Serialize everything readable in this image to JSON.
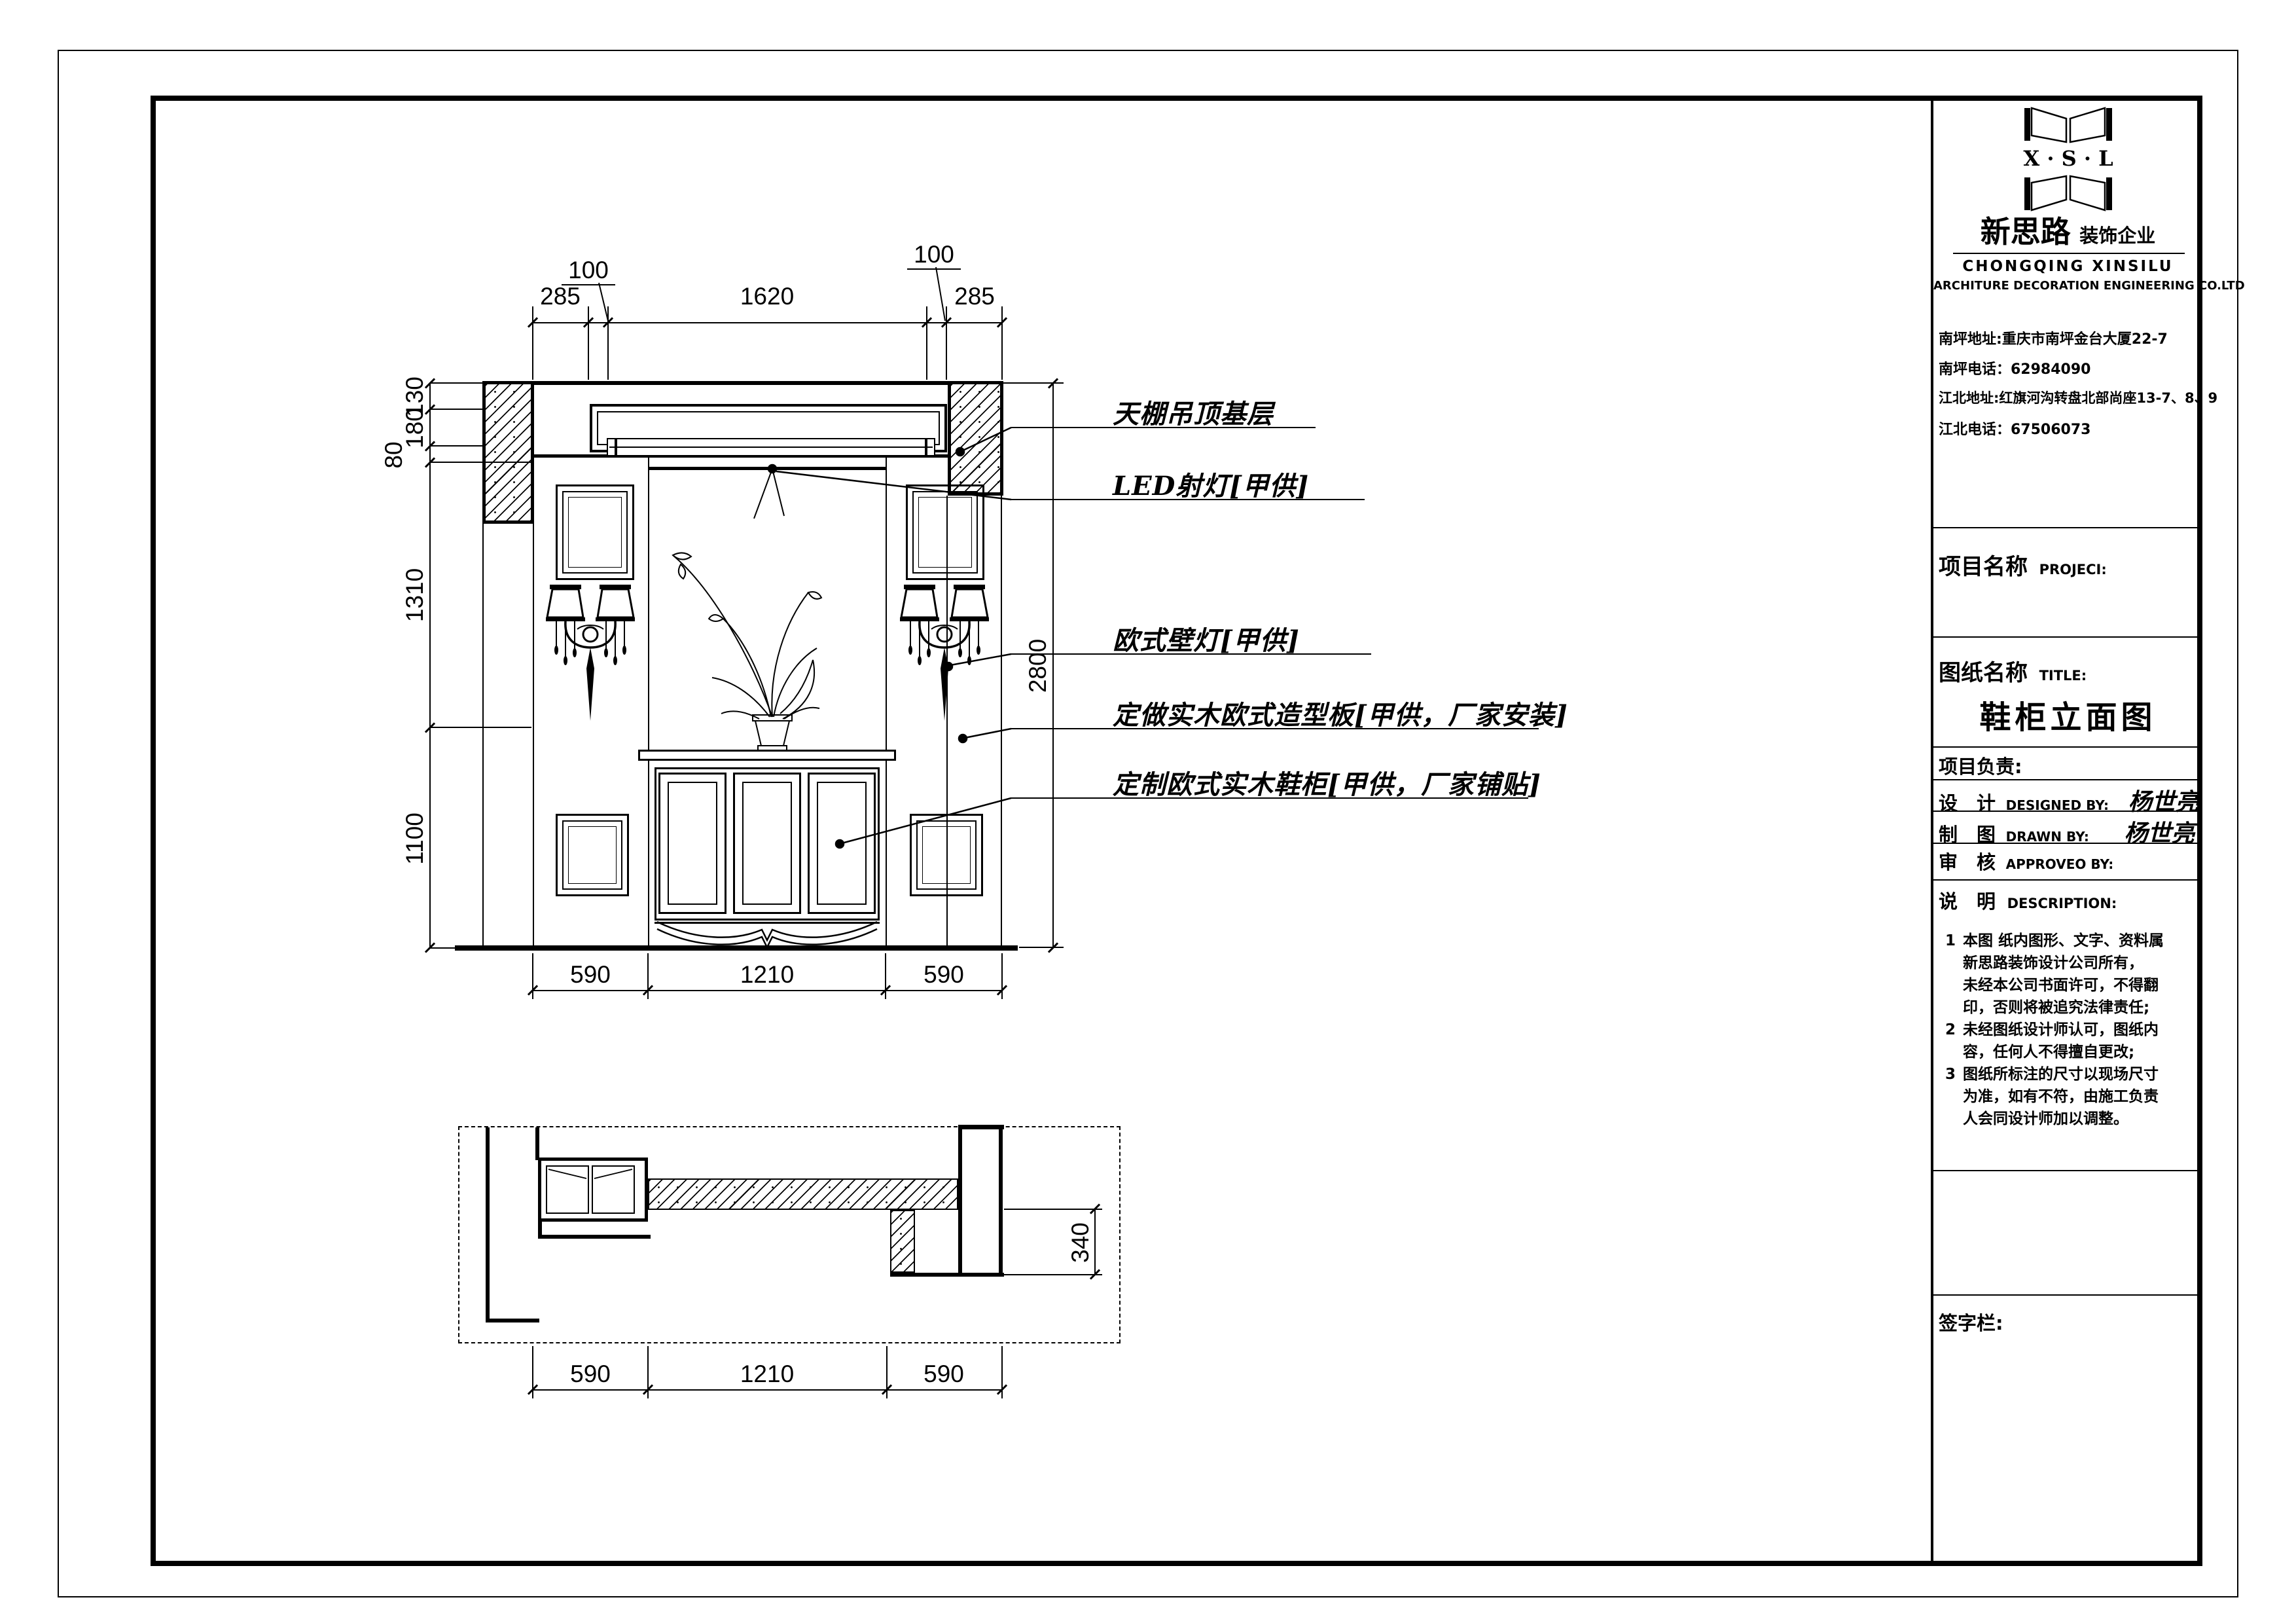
{
  "title_block": {
    "logo": {
      "monogram": "X · S · L",
      "name_cn": "新思路",
      "name_tag": "装饰企业",
      "name_en": "CHONGQING XINSILU",
      "name_en2": "ARCHITURE DECORATION ENGINEERING CO.LTD"
    },
    "contacts": [
      "南坪地址:重庆市南坪金台大厦22-7",
      "南坪电话：62984090",
      "江北地址:红旗河沟转盘北部尚座13-7、8、9",
      "江北电话：67506073"
    ],
    "project_label": "项目名称",
    "project_label_en": "PROJECI:",
    "sheet_label": "图纸名称",
    "sheet_label_en": "TITLE:",
    "sheet_title": "鞋柜立面图",
    "lead_label": "项目负责:",
    "roles": [
      {
        "cn": "设　计",
        "en": "DESIGNED BY:",
        "value": "杨世亮"
      },
      {
        "cn": "制　图",
        "en": "DRAWN BY:",
        "value": "杨世亮"
      },
      {
        "cn": "审　核",
        "en": "APPROVEO BY:",
        "value": ""
      }
    ],
    "desc_label": "说　明",
    "desc_label_en": "DESCRIPTION:",
    "description": [
      {
        "n": "1",
        "t": "本图 纸内图形、文字、资料属"
      },
      {
        "n": "",
        "t": "新思路装饰设计公司所有，"
      },
      {
        "n": "",
        "t": "未经本公司书面许可，不得翻"
      },
      {
        "n": "",
        "t": "印，否则将被追究法律责任;"
      },
      {
        "n": "2",
        "t": "未经图纸设计师认可，图纸内"
      },
      {
        "n": "",
        "t": "容，任何人不得擅自更改;"
      },
      {
        "n": "3",
        "t": "图纸所标注的尺寸以现场尺寸"
      },
      {
        "n": "",
        "t": "为准，如有不符，由施工负责"
      },
      {
        "n": "",
        "t": "人会同设计师加以调整。"
      }
    ],
    "signature_label": "签字栏:"
  },
  "annotations": [
    "天棚吊顶基层",
    "LED射灯[甲供]",
    "欧式壁灯[甲供]",
    "定做实木欧式造型板[甲供，厂家安装]",
    "定制欧式实木鞋柜[甲供，厂家铺贴]"
  ],
  "dimensions": {
    "top": [
      "285",
      "100",
      "1620",
      "100",
      "285"
    ],
    "left": [
      "130",
      "180",
      "80",
      "1310",
      "1100"
    ],
    "right": "2800",
    "elev_bottom": [
      "590",
      "1210",
      "590"
    ],
    "plan_right": "340",
    "plan_bottom": [
      "590",
      "1210",
      "590"
    ]
  },
  "colors": {
    "ink": "#000000",
    "paper": "#ffffff"
  }
}
